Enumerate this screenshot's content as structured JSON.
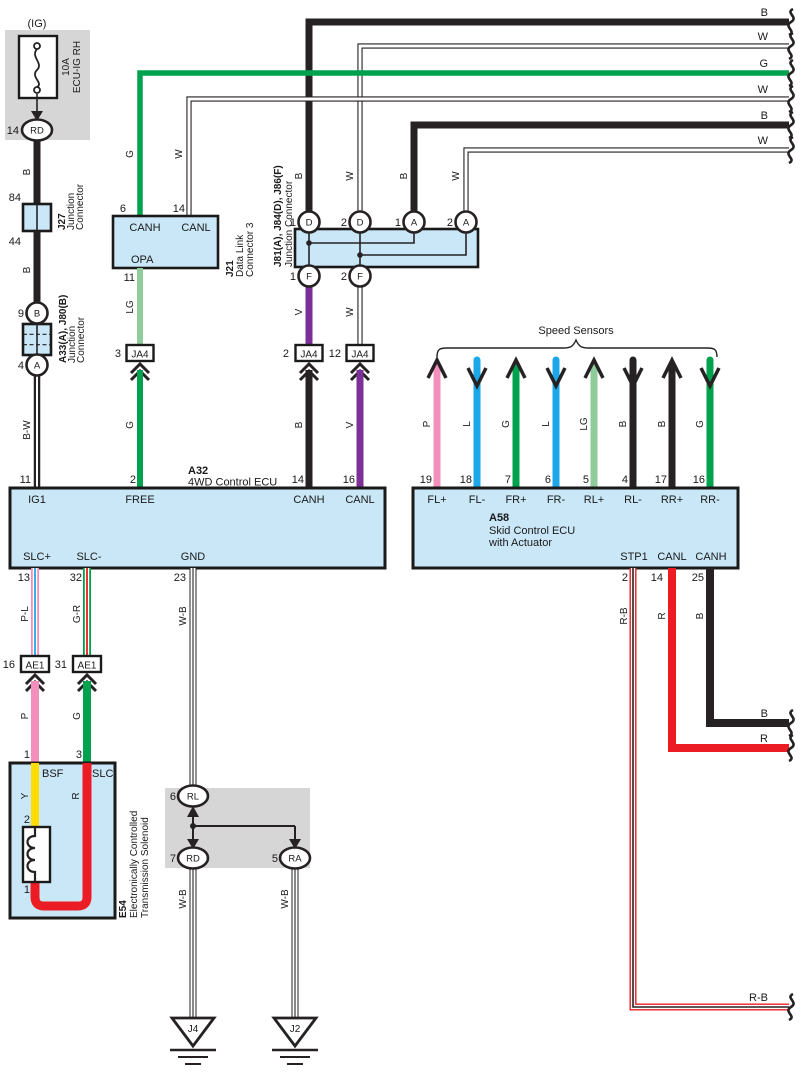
{
  "colors": {
    "ink": "#262223",
    "panel_fill": "#C9E7F7",
    "gray_bg": "#D6D6D6",
    "green": "#00A24E",
    "light_green": "#8FCB9B",
    "violet": "#7B2F97",
    "pink": "#F290BB",
    "blue": "#1BA7E8",
    "yellow": "#FFDD00",
    "red": "#EC1C24",
    "white": "#FFFFFF"
  },
  "exits_top": [
    "B",
    "W",
    "G",
    "W",
    "B",
    "W"
  ],
  "exits_right": {
    "canh": "B",
    "canl": "R",
    "stp1": "R-B"
  },
  "fuse": {
    "title": "(IG)",
    "amp": "10A",
    "name": "ECU-IG RH",
    "pin": "14",
    "terminal": "RD"
  },
  "left_branch": {
    "wire_top": "B",
    "pin_84": "84",
    "pin_44": "44",
    "wire_mid": "B",
    "pin_9": "9",
    "term_top": "B",
    "pin_4": "4",
    "term_bottom": "A",
    "wire_bottom": "B-W"
  },
  "j27": {
    "id": "J27",
    "type_lines": [
      "Junction",
      "Connector"
    ]
  },
  "a33": {
    "id": "A33(A), J80(B)",
    "type_lines": [
      "Junction",
      "Connector"
    ]
  },
  "j21": {
    "id": "J21",
    "type_lines": [
      "Data Link",
      "Connector 3"
    ],
    "canh": {
      "pin": "6",
      "label": "CANH",
      "wire": "G"
    },
    "canl": {
      "pin": "14",
      "label": "CANL",
      "wire": "W"
    },
    "opa": {
      "pin": "11",
      "label": "OPA",
      "wire": "LG"
    }
  },
  "j81": {
    "id": "J81(A), J84(D), J86(F)",
    "type": "Junction Connector",
    "top_pins": [
      {
        "n": "1",
        "t": "D",
        "wire": "B"
      },
      {
        "n": "2",
        "t": "D",
        "wire": "W"
      },
      {
        "n": "1",
        "t": "A",
        "wire": "B"
      },
      {
        "n": "2",
        "t": "A",
        "wire": "W"
      }
    ],
    "bottom_pins": [
      {
        "n": "1",
        "t": "F",
        "wire": "V"
      },
      {
        "n": "2",
        "t": "F",
        "wire": "W"
      }
    ]
  },
  "ja4": {
    "left": {
      "pin": "3",
      "label": "JA4",
      "wire_below": "G"
    },
    "mid": {
      "pin": "2",
      "label": "JA4",
      "wire_below": "B"
    },
    "right": {
      "pin": "12",
      "label": "JA4",
      "wire_below": "V"
    }
  },
  "a32": {
    "id": "A32",
    "name": "4WD Control ECU",
    "top_terminals": [
      {
        "pin": "11",
        "label": "IG1"
      },
      {
        "pin": "2",
        "label": "FREE"
      },
      {
        "pin": "14",
        "label": "CANH"
      },
      {
        "pin": "16",
        "label": "CANL"
      }
    ],
    "bottom_terminals": [
      {
        "pin": "13",
        "label": "SLC+",
        "wire": "P-L"
      },
      {
        "pin": "32",
        "label": "SLC-",
        "wire": "G-R"
      },
      {
        "pin": "23",
        "label": "GND",
        "wire": "W-B"
      }
    ]
  },
  "a58": {
    "id": "A58",
    "name_lines": [
      "Skid Control ECU",
      "with Actuator"
    ],
    "top_terminals": [
      {
        "pin": "19",
        "label": "FL+",
        "wire": "P"
      },
      {
        "pin": "18",
        "label": "FL-",
        "wire": "L"
      },
      {
        "pin": "7",
        "label": "FR+",
        "wire": "G"
      },
      {
        "pin": "6",
        "label": "FR-",
        "wire": "L"
      },
      {
        "pin": "5",
        "label": "RL+",
        "wire": "LG"
      },
      {
        "pin": "4",
        "label": "RL-",
        "wire": "B"
      },
      {
        "pin": "17",
        "label": "RR+",
        "wire": "B"
      },
      {
        "pin": "16",
        "label": "RR-",
        "wire": "G"
      }
    ],
    "bottom_terminals": [
      {
        "pin": "2",
        "label": "STP1",
        "wire": "R-B"
      },
      {
        "pin": "14",
        "label": "CANL",
        "wire": "R"
      },
      {
        "pin": "25",
        "label": "CANH",
        "wire": "B"
      }
    ]
  },
  "speed_sensors": {
    "title": "Speed Sensors"
  },
  "ae1": {
    "left": {
      "pin": "16",
      "label": "AE1",
      "wire_below": "P"
    },
    "right": {
      "pin": "31",
      "label": "AE1",
      "wire_below": "G"
    }
  },
  "e54": {
    "id": "E54",
    "type_lines": [
      "Electronically Controlled",
      "Transmission Solenoid"
    ],
    "bsf": {
      "pin": "1",
      "label": "BSF",
      "wire": "Y"
    },
    "slc": {
      "pin": "3",
      "label": "SLC",
      "wire": "R"
    },
    "coil_pin_top": "2",
    "coil_pin_bottom": "1"
  },
  "ground_block": {
    "rl": {
      "pin": "6",
      "t": "RL"
    },
    "rd": {
      "pin": "7",
      "t": "RD",
      "wire": "W-B"
    },
    "ra": {
      "pin": "5",
      "t": "RA",
      "wire": "W-B"
    }
  },
  "grounds": {
    "left": "J4",
    "right": "J2"
  }
}
